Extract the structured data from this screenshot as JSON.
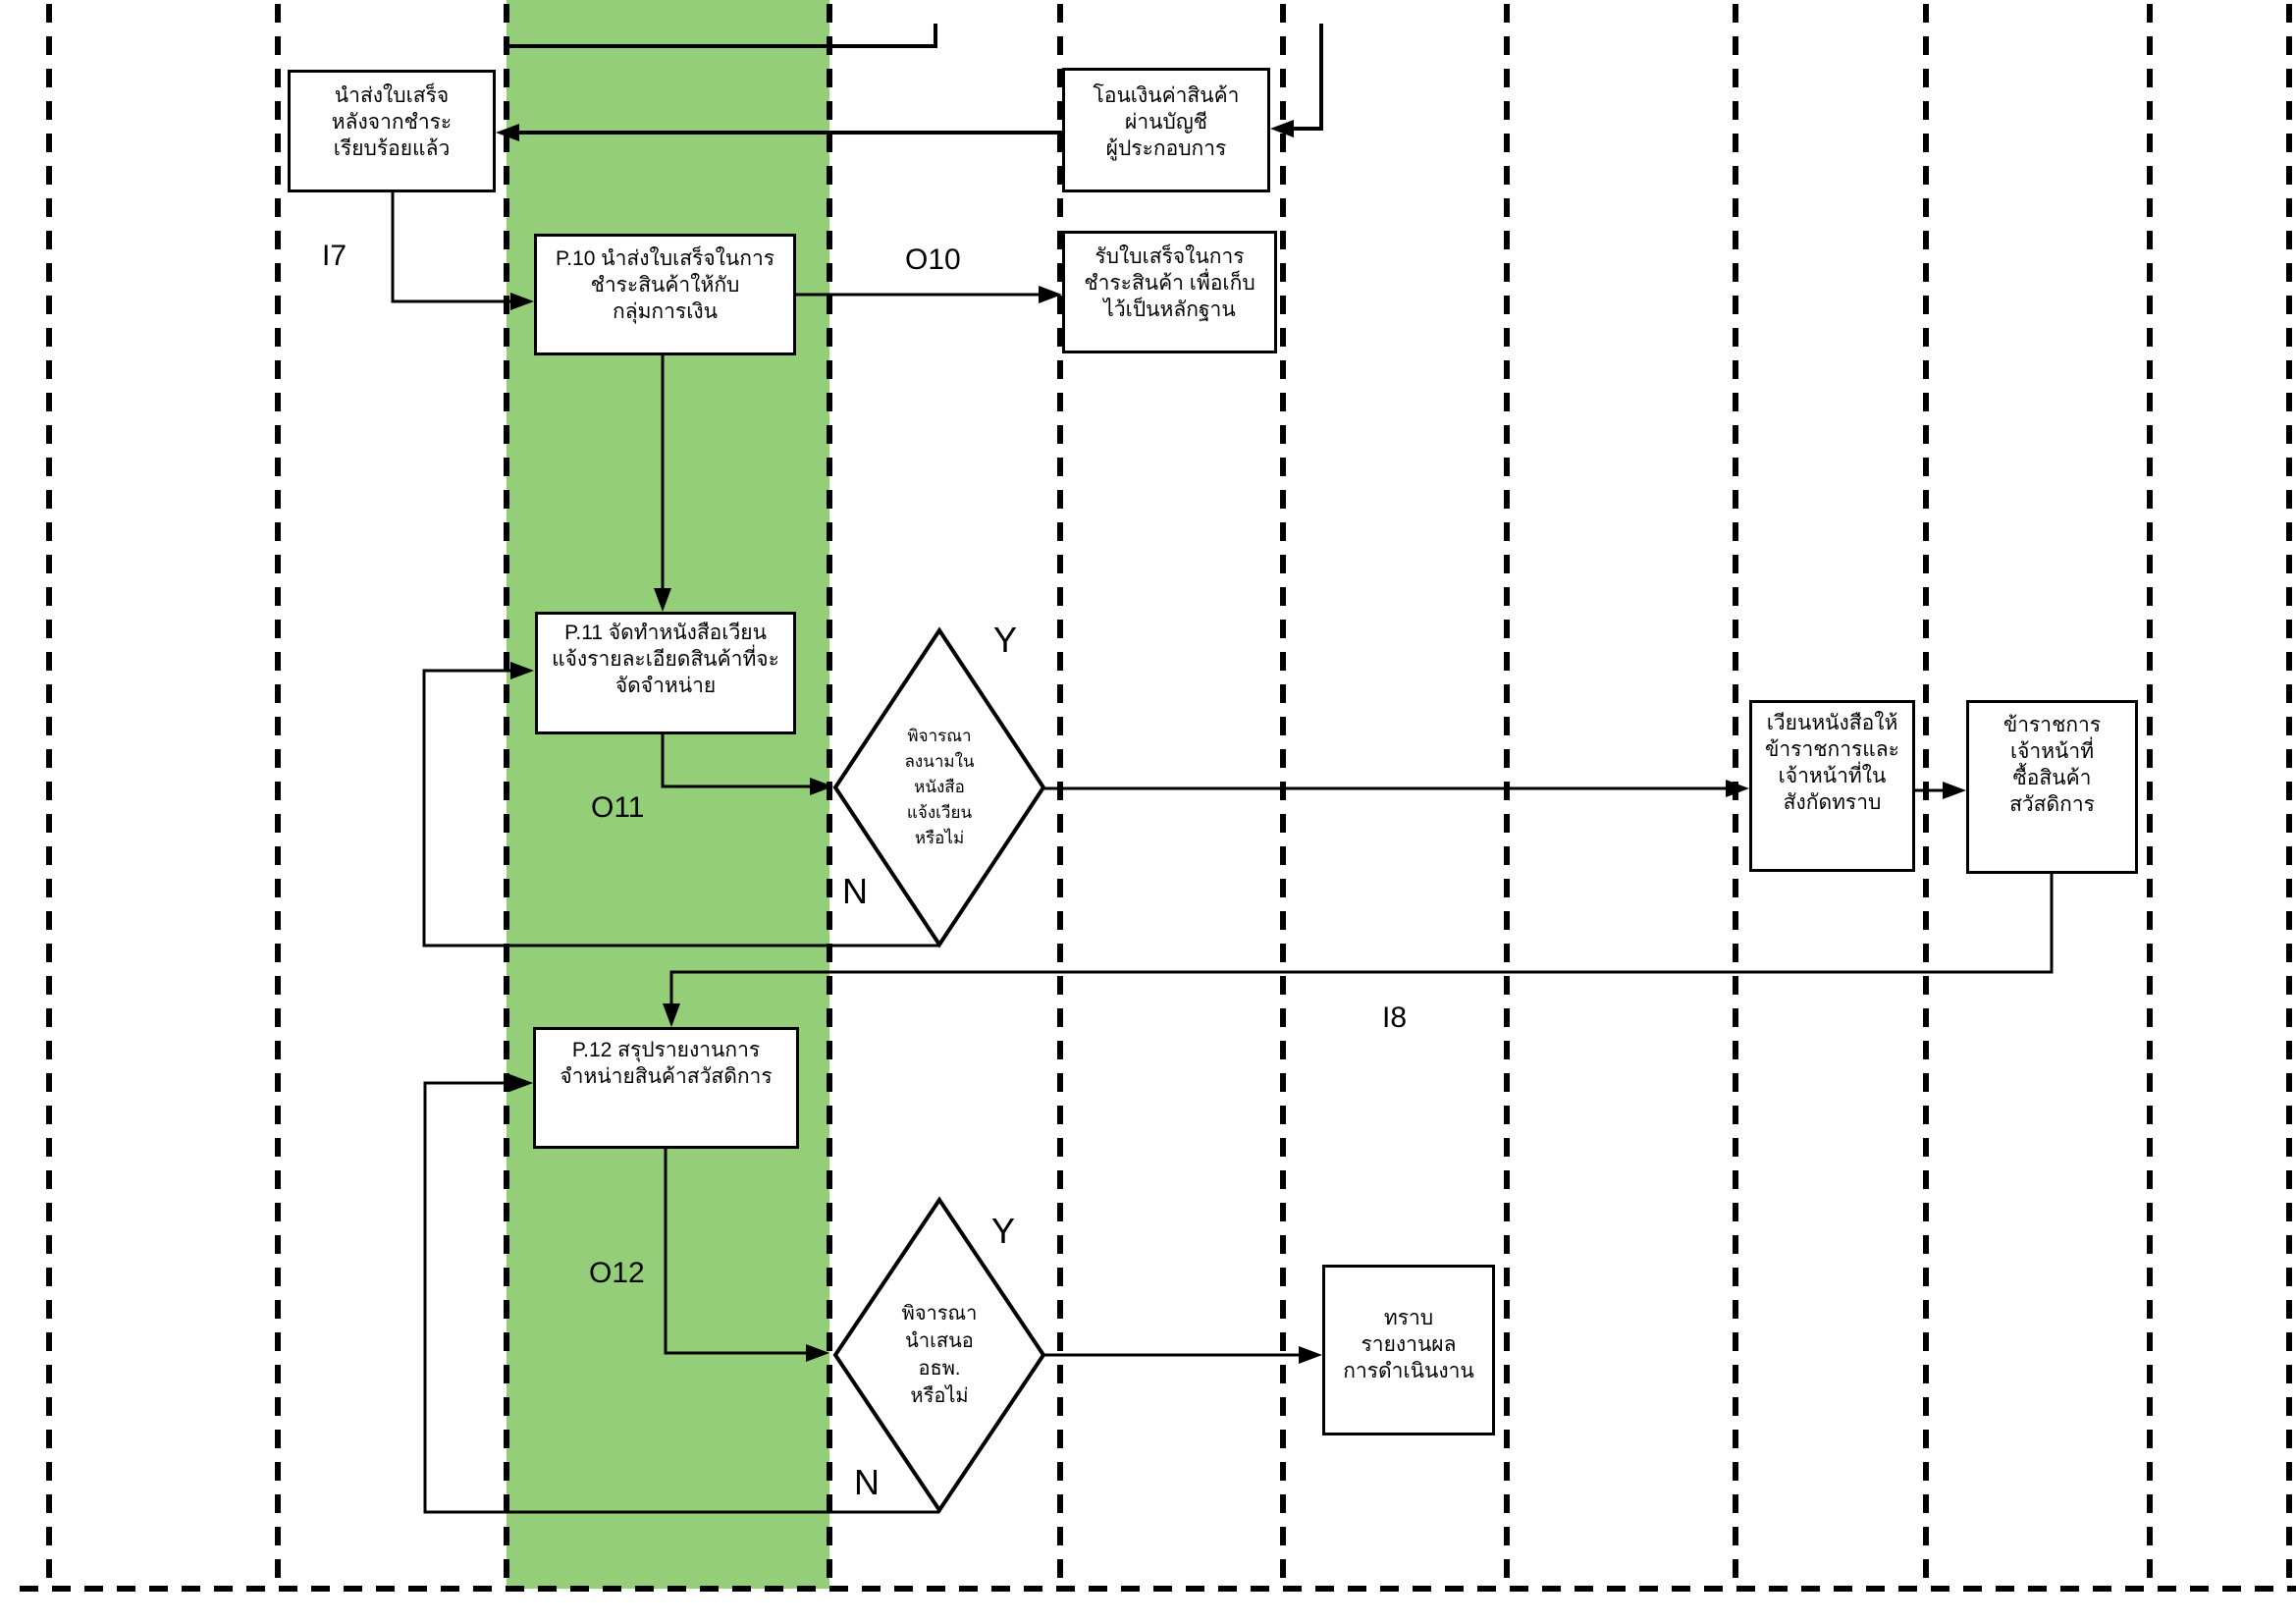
{
  "diagram": {
    "type": "flowchart-swimlane",
    "colors": {
      "highlight_lane": "#94CE78",
      "line": "#000000",
      "background": "#FFFFFF"
    },
    "boxes": {
      "receipt_delivered": "นำส่งใบเสร็จ\nหลังจากชำระ\nเรียบร้อยแล้ว",
      "transfer_money": "โอนเงินค่าสินค้า\nผ่านบัญชี\nผู้ประกอบการ",
      "p10": "P.10 นำส่งใบเสร็จในการ\nชำระสินค้าให้กับ\nกลุ่มการเงิน",
      "receive_receipt": "รับใบเสร็จในการ\nชำระสินค้า เพื่อเก็บ\nไว้เป็นหลักฐาน",
      "p11": "P.11 จัดทำหนังสือเวียน\nแจ้งรายละเอียดสินค้าที่จะ\nจัดจำหน่าย",
      "circulate_letter": "เวียนหนังสือให้\nข้าราชการและ\nเจ้าหน้าที่ใน\nสังกัดทราบ",
      "officials_buy": "ข้าราชการ\nเจ้าหน้าที่\nซื้อสินค้า\nสวัสดิการ",
      "p12": "P.12 สรุปรายงานการ\nจำหน่ายสินค้าสวัสดิการ",
      "acknowledge_report": "ทราบ\nรายงานผล\nการดำเนินงาน"
    },
    "decisions": {
      "sign_circular": "พิจารณา\nลงนามใน\nหนังสือ\nแจ้งเวียน\nหรือไม่",
      "present_director": "พิจารณา\nนำเสนอ\nอธพ.\nหรือไม่"
    },
    "labels": {
      "i7": "I7",
      "o10": "O10",
      "o11": "O11",
      "o12": "O12",
      "i8": "I8",
      "yes1": "Y",
      "no1": "N",
      "yes2": "Y",
      "no2": "N"
    }
  }
}
